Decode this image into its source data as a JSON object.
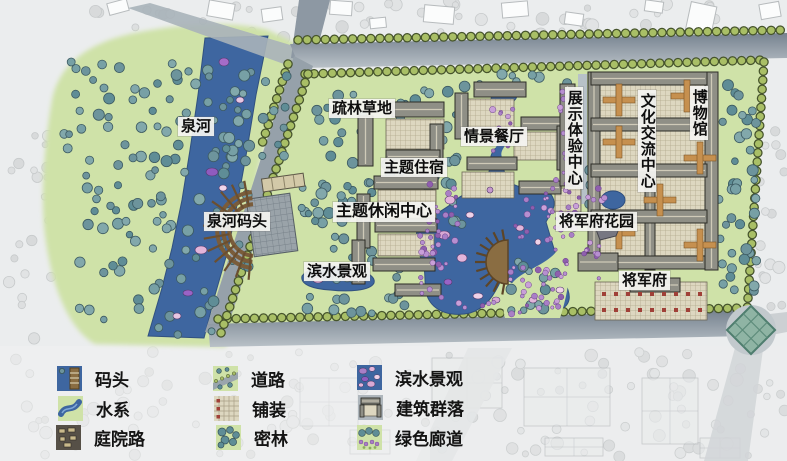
{
  "labels": {
    "quanhe": "泉河",
    "quanhe_dock": "泉河码头",
    "meadow": "疏林草地",
    "restaurant": "情景餐厅",
    "lodging": "主题住宿",
    "leisure": "主题休闲中心",
    "waterfront": "滨水景观",
    "exhibition": "展示体验中心",
    "culture": "文化交流中心",
    "museum": "博物馆",
    "garden": "将军府花园",
    "mansion": "将军府"
  },
  "legend": {
    "columns": [
      {
        "items": [
          {
            "name": "dock",
            "label": "码头"
          },
          {
            "name": "water-system",
            "label": "水系"
          },
          {
            "name": "courtyard-road",
            "label": "庭院路"
          }
        ]
      },
      {
        "items": [
          {
            "name": "road",
            "label": "道路"
          },
          {
            "name": "paving",
            "label": "铺装"
          },
          {
            "name": "dense-forest",
            "label": "密林"
          }
        ]
      },
      {
        "items": [
          {
            "name": "waterfront-landscape",
            "label": "滨水景观"
          },
          {
            "name": "building-cluster",
            "label": "建筑群落"
          },
          {
            "name": "green-corridor",
            "label": "绿色廊道"
          }
        ]
      }
    ]
  },
  "colors": {
    "background": "#ebedee",
    "site_green": "#cfe2a8",
    "water_blue": "#3e66a0",
    "road_dark": "#7c8795",
    "road_light": "#b3bcc3",
    "tree_canopy_teal": "#6d949c",
    "tree_row_green": "#a9bf66",
    "shrub_purple": "#a97fc6",
    "deck_brown": "#8a6d42",
    "roof_gray": "#8f8f86",
    "paving_tan": "#ddd7c0",
    "accent_red": "#a04038",
    "cross_orange": "#c6904f"
  }
}
